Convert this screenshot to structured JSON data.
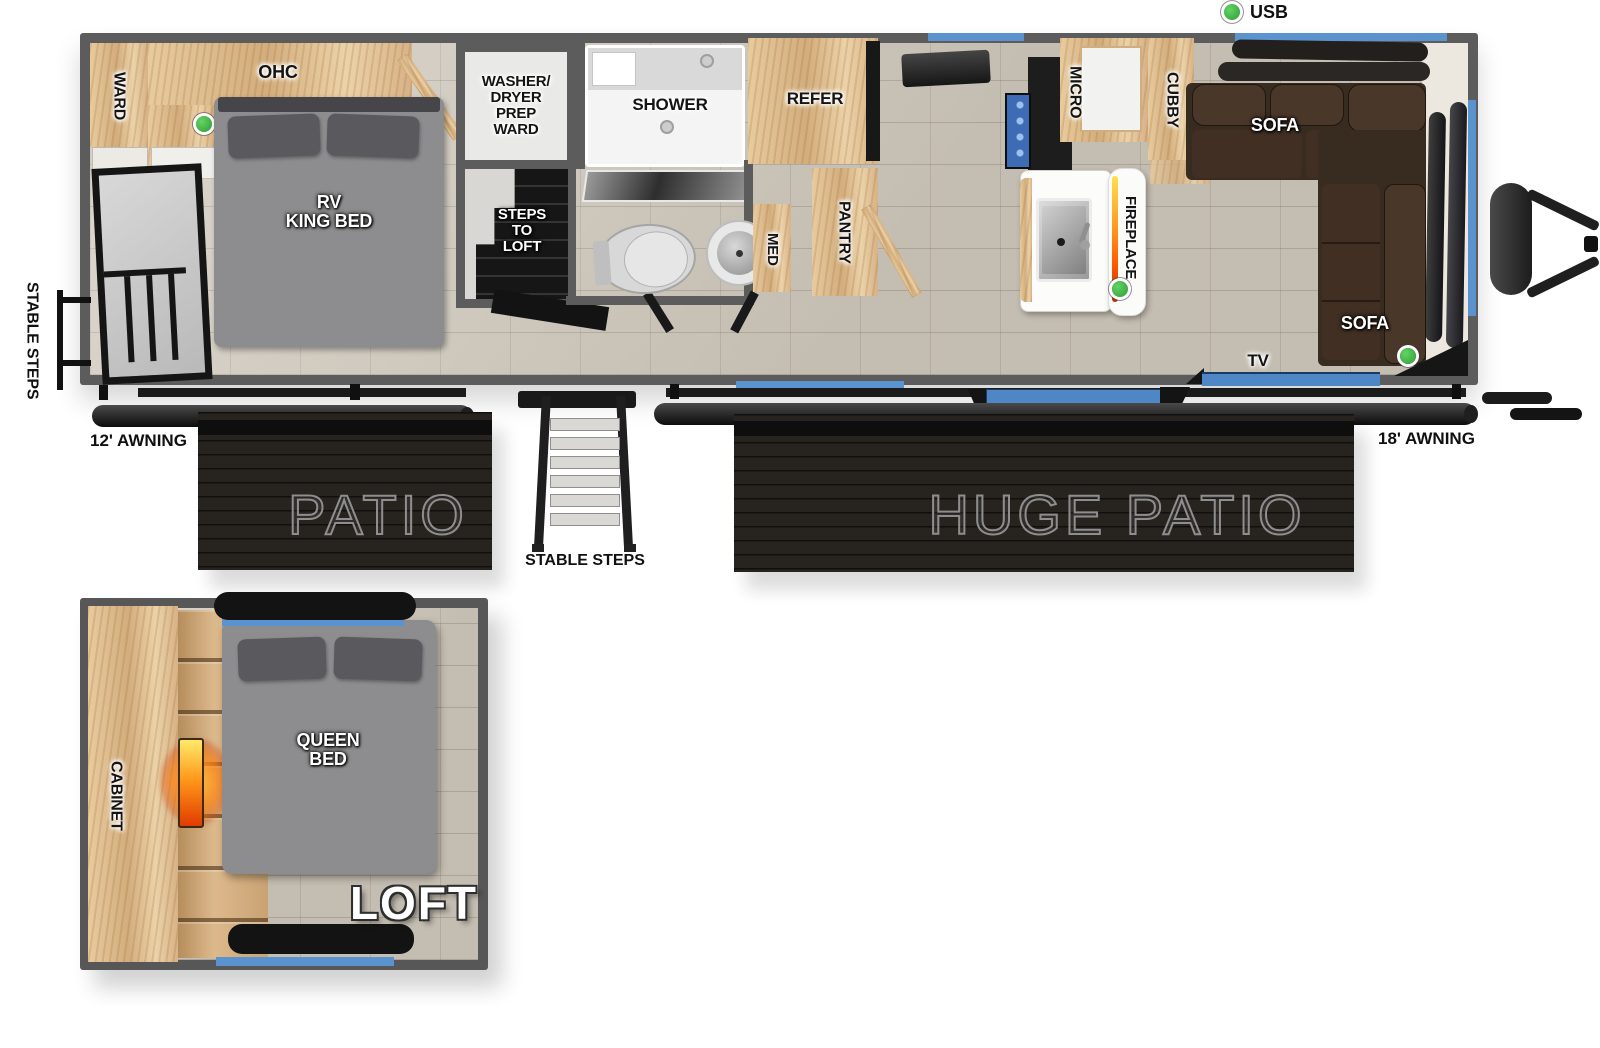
{
  "legend": {
    "usb": "USB"
  },
  "main": {
    "ward": "WARD",
    "ohc": "OHC",
    "king_bed": "RV\nKING BED",
    "washer_room": "WASHER/\nDRYER\nPREP\nWARD",
    "steps_to_loft": "STEPS\nTO\nLOFT",
    "shower": "SHOWER",
    "med": "MED",
    "refer": "REFER",
    "pantry": "PANTRY",
    "micro": "MICRO",
    "cubby": "CUBBY",
    "fireplace": "FIREPLACE",
    "sofa_top": "SOFA",
    "sofa_side": "SOFA",
    "tv": "TV"
  },
  "exterior": {
    "stable_steps_left": "STABLE STEPS",
    "awning_12": "12' AWNING",
    "patio": "PATIO",
    "stable_steps_center": "STABLE STEPS",
    "huge_patio": "HUGE PATIO",
    "awning_18": "18' AWNING"
  },
  "loft": {
    "cabinet": "CABINET",
    "queen_bed": "QUEEN\nBED",
    "title": "LOFT"
  },
  "colors": {
    "wall": "#5c5c5c",
    "floor_tile": "#d0c9bc",
    "wood": "#debf92",
    "accent_blue": "#5b93cf",
    "usb_green": "#3cb54a",
    "sofa_brown": "#382b20",
    "patio_black": "#272420"
  }
}
